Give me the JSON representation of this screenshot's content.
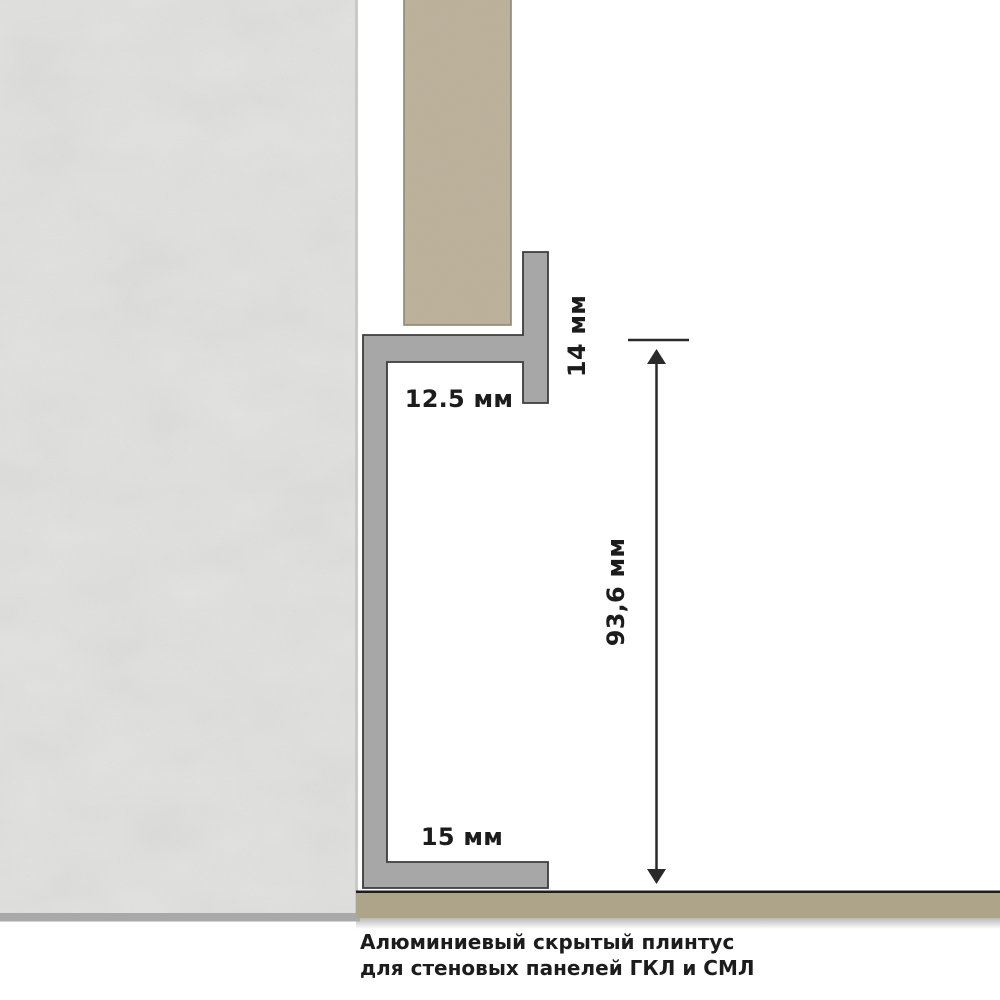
{
  "diagram": {
    "type": "technical-profile-section",
    "labels": {
      "flange_height": "14 мм",
      "panel_thickness": "12.5 мм",
      "total_height": "93,6 мм",
      "bottom_flange": "15 мм"
    },
    "caption": {
      "line1": "Алюминиевый скрытый плинтус",
      "line2": "для стеновых панелей ГКЛ и СМЛ"
    },
    "colors": {
      "background": "#ffffff",
      "wall": "#dcdcda",
      "wall_edge": "#c9c9c5",
      "wall_bottom_band": "#a9a9a9",
      "panel": "#bdb29c",
      "panel_border": "#8e8778",
      "profile_fill": "#a7a7a7",
      "profile_outline": "#3c3c3c",
      "floor_line": "#1d1d1d",
      "floor": "#aea489",
      "floor_shadow": "#bdbdbd",
      "dimension": "#2a2a2a",
      "text": "#1c1c1c"
    }
  }
}
